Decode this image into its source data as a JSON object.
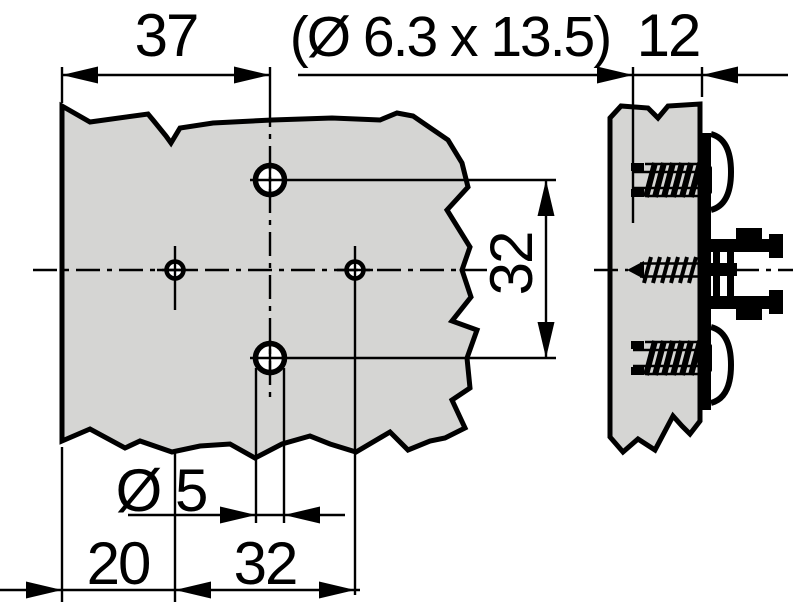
{
  "drawing": {
    "type": "technical-dimension-drawing",
    "subject": "hinge mounting plate with screws",
    "views": {
      "front": "front view of mounting plate on panel",
      "side": "side section of panel with euro screws and clip plate"
    },
    "dimensions": {
      "width_37": "37",
      "screw_spec": "(Ø 6.3 x 13.5)",
      "depth_12": "12",
      "vertical_hole_spacing_32": "32",
      "hole_diameter": "Ø 5",
      "edge_offset_20": "20",
      "horizontal_hole_spacing_32": "32"
    },
    "colors": {
      "panel_fill": "#d5d5d3",
      "line": "#000000",
      "background": "#ffffff"
    }
  }
}
